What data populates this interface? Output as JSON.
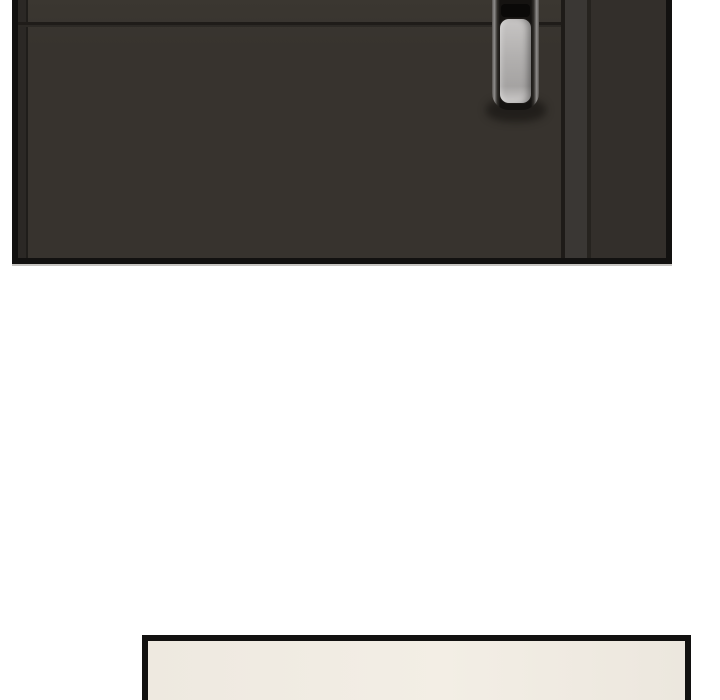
{
  "page": {
    "kind": "comic-strip-fragment",
    "width": 720,
    "height": 700,
    "background": "#ffffff"
  },
  "panels": [
    {
      "id": "door-panel",
      "description": "dark brown door with vertical metallic pull handle, cropped at top of frame",
      "border_thickness_px": 6,
      "bounds": {
        "left": 12,
        "top": 0,
        "right": 672,
        "bottom": 264
      }
    },
    {
      "id": "bottom-panel",
      "description": "empty cream panel just entering frame, cropped at bottom",
      "border_thickness_px": 6,
      "bounds": {
        "left": 142,
        "top": 635,
        "right": 691,
        "bottom": 700
      }
    }
  ],
  "colors": {
    "page_bg": "#ffffff",
    "panel_border": "#121110",
    "door_face": "#37332e",
    "door_face_light": "#3b3731",
    "hinge_strip": "#2b2825",
    "hinge_line": "#1f1d1a",
    "seam_dark": "#1f1c19",
    "seam_light": "#2c2925",
    "edge_seam": "#1e1b18",
    "jamb_strip": "#3a3734",
    "jamb_line": "#26231f",
    "wall_right": "#332f2b",
    "casing_dark": "#151311",
    "casing_metal": "#908e8c",
    "casing_metal_dim": "#55524f",
    "grip_light": "#c7c5c4",
    "grip_mid": "#b2b0af",
    "grip_dark": "#a5a3a2",
    "grip_sheen": "#cac8c7",
    "recess": "#0a0908",
    "handle_shadow": "rgba(12,10,8,0.5)",
    "cream_left": "#eee9e0",
    "cream_mid": "#f3eee5",
    "cream_right": "#ece7de"
  }
}
